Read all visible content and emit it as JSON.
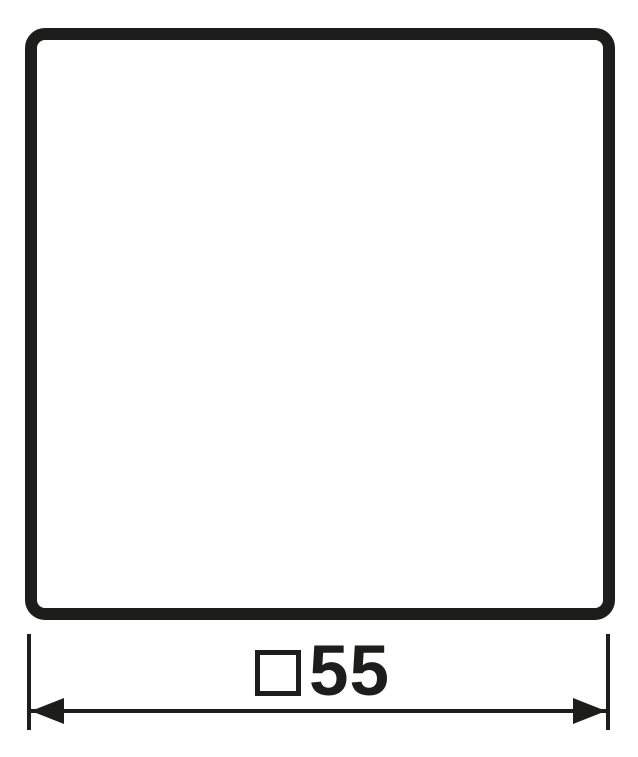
{
  "colors": {
    "line": "#1d1d1b",
    "background": "#ffffff"
  },
  "drawing": {
    "kind": "dimension-drawing",
    "plate": {
      "shape": "rounded-square-outline"
    },
    "dimension": {
      "symbol": "□",
      "value": "55",
      "label": "□55"
    }
  }
}
